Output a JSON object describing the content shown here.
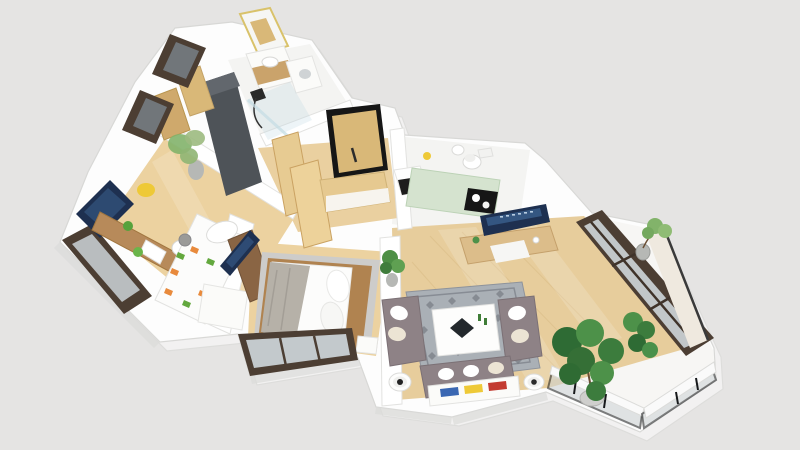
{
  "scene": {
    "type": "3d-floor-plan-render",
    "description": "Isometric 3D rendered floor plan of a two-bedroom apartment with hallway, bathroom, WC, kitchen, living room and wrap-around glass balcony",
    "background_color": "#e5e4e3",
    "shadow_color": "#d2d2d0"
  },
  "colors": {
    "wall": "#fdfdfd",
    "wall_edge": "#d8d8d6",
    "wall_shade": "#dcdcda",
    "wood_floor_bedroom": "#ecd2a0",
    "wood_floor_living": "#e7cd9c",
    "wood_floor_hall": "#ead0a0",
    "marble_floor": "#f4f4f2",
    "balcony_floor": "#f7f6f4",
    "window_frame": "#4c3e33",
    "glass": "#ccd3d6",
    "glass_dark": "#71767a",
    "wardrobe_dark": "#4e5358",
    "door_wood": "#d9b878",
    "light_wood": "#e6c990",
    "desk_wood": "#b78a5a",
    "console_wood": "#8a6544",
    "tv_screen": "#1e3050",
    "tv_glow": "#3c6392",
    "mint_counter": "#d5e3cf",
    "cooktop_black": "#161616",
    "sofa_gray": "#8e8286",
    "pillow_white": "#ffffff",
    "pillow_tan": "#ece4d4",
    "rug_living": "#aab0b6",
    "rug_pattern": "#676d75",
    "rug_bedroom": "#cdccca",
    "bed_white": "#fcfcfb",
    "blanket_gray": "#b6b1a8",
    "bed_frame_wood": "#b08350",
    "plant_dark": "#2e6b34",
    "plant_mid": "#4d9149",
    "plant_light": "#82b36a",
    "pot_gray": "#b6b8b5",
    "balcony_wall": "#efe9df",
    "railing_black": "#17191b",
    "white_furniture": "#fbfbf9",
    "accent_yellow": "#eec937",
    "accent_orange": "#e88a3c",
    "accent_green": "#63a83e",
    "accent_blue": "#3a67b2",
    "accent_red": "#c33b31"
  },
  "rooms": [
    {
      "name": "kids-bedroom",
      "floor": "wood"
    },
    {
      "name": "master-bedroom",
      "floor": "wood"
    },
    {
      "name": "hallway",
      "floor": "wood"
    },
    {
      "name": "bathroom",
      "floor": "marble"
    },
    {
      "name": "wc",
      "floor": "marble"
    },
    {
      "name": "kitchen",
      "floor": "marble"
    },
    {
      "name": "living-room",
      "floor": "wood"
    },
    {
      "name": "balcony",
      "floor": "stone"
    }
  ],
  "furniture": {
    "kids_bedroom": [
      "wall-tv",
      "desk",
      "desk-chair",
      "yellow-stool",
      "toy-bins",
      "single-bed",
      "plush-toy",
      "floor-plant",
      "low-window",
      "upper-window-1",
      "upper-window-2",
      "white-dresser"
    ],
    "master_bedroom": [
      "double-bed",
      "pillows",
      "throw-blanket",
      "area-rug",
      "tv-sideboard",
      "tv",
      "nightstand",
      "window"
    ],
    "hallway": [
      "entry-door",
      "open-door-leaf-1",
      "open-door-leaf-2",
      "shoe-cabinet",
      "wardrobe"
    ],
    "bathroom": [
      "mirror",
      "vanity-sink",
      "washing-machine",
      "shower"
    ],
    "wc": [
      "toilet",
      "hand-basin"
    ],
    "kitchen": [
      "counter",
      "cooktop",
      "oven",
      "kettle"
    ],
    "living_room": [
      "media-console",
      "tv",
      "floor-plant",
      "area-rug",
      "coffee-table",
      "sofa-left",
      "sofa-right",
      "sofa-bottom",
      "bookshelf",
      "side-table-left",
      "side-table-right",
      "large-plant",
      "medium-plant"
    ],
    "balcony": [
      "glass-railing",
      "parapet-wall",
      "potted-plant"
    ]
  }
}
